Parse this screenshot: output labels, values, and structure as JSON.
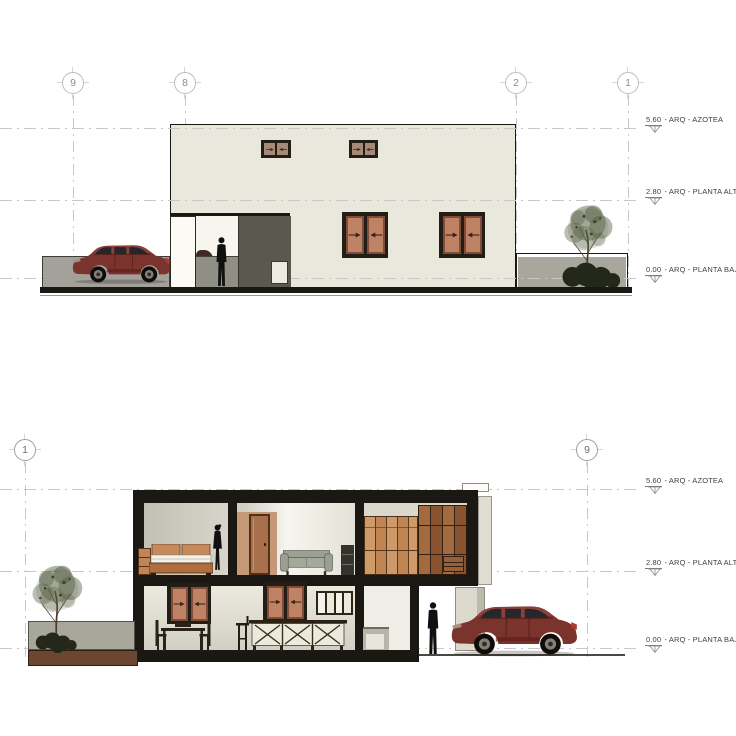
{
  "sheet": {
    "type_note": "architectural elevation and section drawing"
  },
  "colors": {
    "paper": "#ffffff",
    "line": "#c7c7c7",
    "tick": "#d6d6d6",
    "bubble-stroke": "#bdbdbd",
    "bubble-text": "#8c8c8c",
    "text": "#3f3f3f",
    "ink": "#1b1712",
    "facade": "#eae8dc",
    "frame": "#231d15",
    "glass": "#bf8264",
    "glass-sm": "#a68a78",
    "arrow": "#38241a",
    "recess": "#5a584f",
    "passage": "#908f86",
    "boundary": "#a3a199",
    "interior": "#d5d3c7",
    "door": "#a9714b",
    "door-tan": "#c59878",
    "sofa": "#9aa092",
    "wood-light": "#cf9a6a",
    "wood-mid": "#c08552",
    "wood-dark": "#8a5330",
    "counter": "#eceadd",
    "column": "#dcdacd",
    "planter": "#6b4630",
    "planter-wall": "#a8a79c",
    "foliage": "#566042",
    "bush": "#23281a",
    "car-body": "#7b332d",
    "car-roof": "#8e4038",
    "car-glass": "#24272c"
  },
  "elevation": {
    "grid_bubbles": [
      {
        "label": "9"
      },
      {
        "label": "8"
      },
      {
        "label": "2"
      },
      {
        "label": "1"
      }
    ],
    "levels": [
      {
        "value": "5.60",
        "suffix": "- ARQ - AZOTEA"
      },
      {
        "value": "2.80",
        "suffix": "- ARQ - PLANTA ALTA"
      },
      {
        "value": "0.00",
        "suffix": "- ARQ - PLANTA BAJA"
      }
    ]
  },
  "section": {
    "grid_bubbles": [
      {
        "label": "1"
      },
      {
        "label": "9"
      }
    ],
    "levels": [
      {
        "value": "5.60",
        "suffix": "- ARQ - AZOTEA"
      },
      {
        "value": "2.80",
        "suffix": "- ARQ - PLANTA ALTA"
      },
      {
        "value": "0.00",
        "suffix": "- ARQ - PLANTA BAJA"
      }
    ]
  }
}
